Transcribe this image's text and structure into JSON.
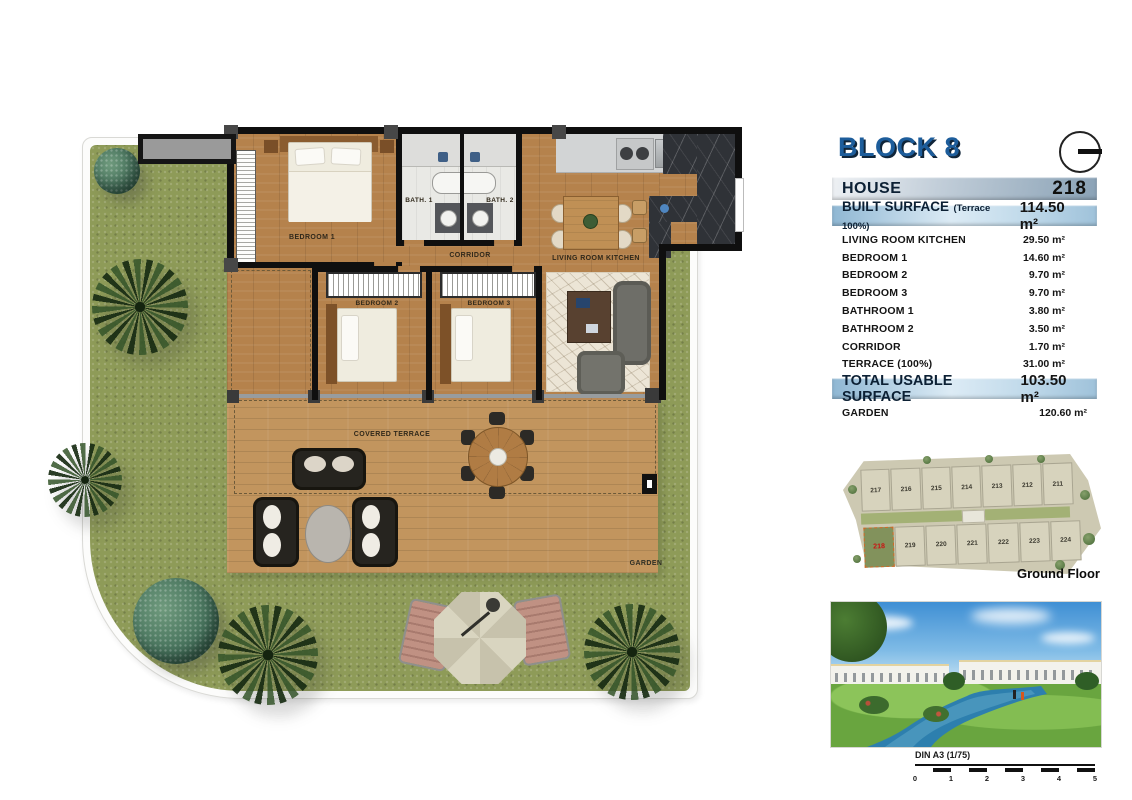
{
  "panel": {
    "block_title": "BLOCK 8",
    "house": {
      "label": "HOUSE",
      "number": "218"
    },
    "built_surface": {
      "label": "BUILT SURFACE",
      "note": "(Terrace 100%)",
      "value": "114.50 m²"
    },
    "rows": [
      {
        "label": "LIVING ROOM KITCHEN",
        "value": "29.50 m²"
      },
      {
        "label": "BEDROOM 1",
        "value": "14.60 m²"
      },
      {
        "label": "BEDROOM 2",
        "value": "9.70 m²"
      },
      {
        "label": "BEDROOM 3",
        "value": "9.70 m²"
      },
      {
        "label": "BATHROOM 1",
        "value": "3.80 m²"
      },
      {
        "label": "BATHROOM 2",
        "value": "3.50 m²"
      },
      {
        "label": "CORRIDOR",
        "value": "1.70 m²"
      },
      {
        "label": "TERRACE (100%)",
        "value": "31.00 m²"
      }
    ],
    "total": {
      "label": "TOTAL USABLE SURFACE",
      "value": "103.50 m²"
    },
    "garden": {
      "label": "GARDEN",
      "value": "120.60 m²"
    }
  },
  "plan": {
    "labels": {
      "bedroom1": "BEDROOM 1",
      "bath1": "BATH. 1",
      "bath2": "BATH. 2",
      "corridor": "CORRIDOR",
      "living": "LIVING ROOM KITCHEN",
      "bedroom2": "BEDROOM 2",
      "bedroom3": "BEDROOM 3",
      "covered_terrace": "COVERED TERRACE",
      "garden": "GARDEN"
    }
  },
  "site_plan": {
    "title": "Ground Floor",
    "top_row": [
      "217",
      "216",
      "215",
      "214",
      "213",
      "212",
      "211"
    ],
    "bottom_row": [
      "218",
      "219",
      "220",
      "221",
      "222",
      "223",
      "224"
    ],
    "highlighted_unit": "218",
    "highlight_color": "#cc1111"
  },
  "scale_bar": {
    "label": "DIN A3 (1/75)",
    "ticks": [
      "0",
      "1",
      "2",
      "3",
      "4",
      "5"
    ]
  },
  "colors": {
    "accent_blue": "#1d5d9b",
    "bar_blue": "#9cc0da",
    "wall": "#0f0f0f",
    "grass": "#8e9b58",
    "wood": "#b5824c",
    "highlight_red": "#cc1111"
  }
}
